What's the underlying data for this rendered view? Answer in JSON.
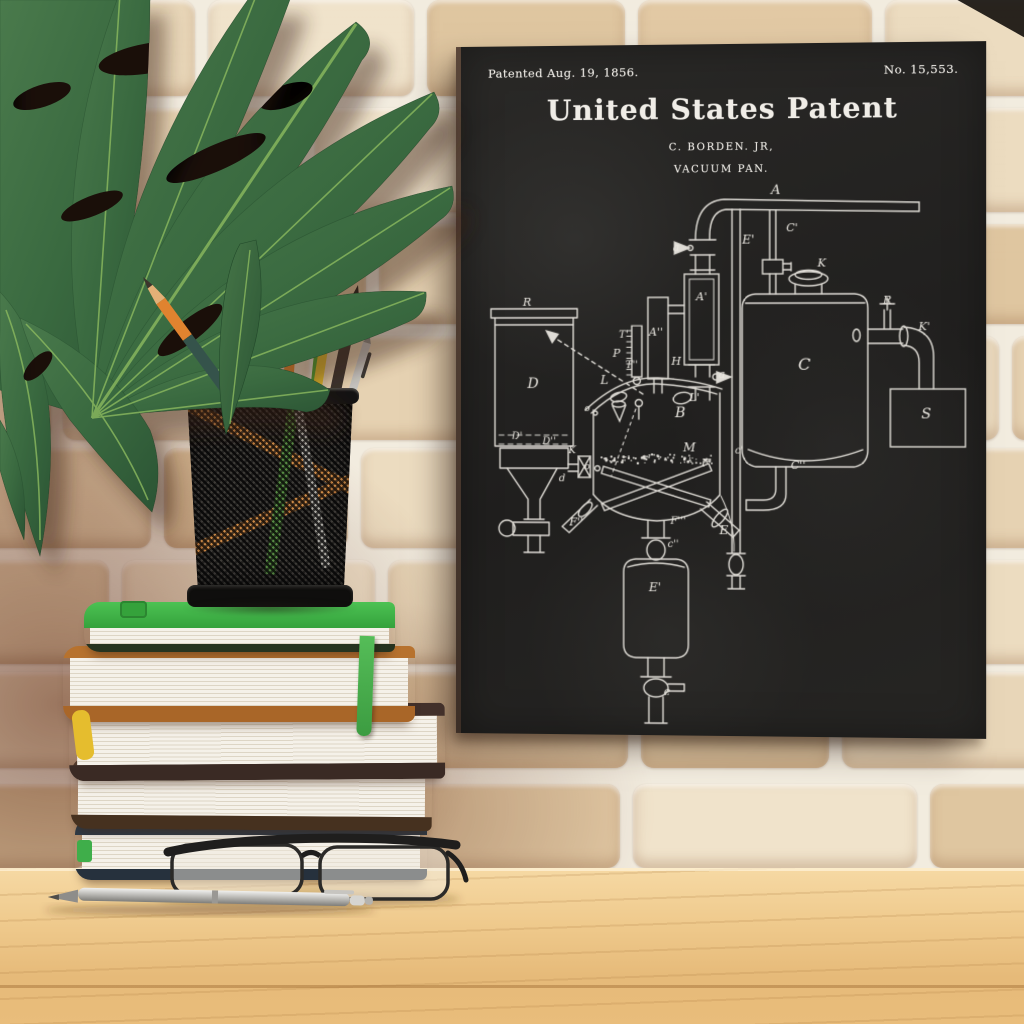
{
  "palette": {
    "mortar": "#f2ecdf",
    "bricks": [
      "#ecdcc0",
      "#e6d2b2",
      "#f0e3cb",
      "#e2c9a4",
      "#eddec2",
      "#e8d6b8",
      "#dfc6a0"
    ],
    "wall_tint_left": "rgba(112,62,45,0.60)",
    "desk_light": "#f6d9a4",
    "desk_dark": "#e6ba79",
    "canvas_black": "#232120",
    "chalk": "#edeae3",
    "leaf_dark": "#2b5434",
    "leaf_light": "#4a7a4c",
    "leaf_vein": "#8cba5f",
    "book_green": "#3fae46",
    "book_caramel": "#b7722e",
    "book_dark_brown": "#42302a",
    "book_brown": "#523a2b",
    "book_navy": "#2d3a47",
    "pages": "#f4f0e8",
    "ribbon_green": "#46b04a",
    "bookmark_yellow": "#e5bd2e",
    "pencil_orange": "#ea8b2e",
    "pencil_teal": "#35534b",
    "pencil_green": "#4da32f",
    "pencil_yellow": "#e0ba2e",
    "pencil_black": "#3b332d",
    "metal_silver": "#c6c5c1",
    "cup_black": "#151413",
    "glasses_frame": "#1f1e1d"
  },
  "canvas_print": {
    "patented": "Patented Aug. 19, 1856.",
    "patent_number": "No. 15,553.",
    "title": "United States Patent",
    "inventor": "C. BORDEN. JR,",
    "subtitle": "VACUUM PAN.",
    "diagram_labels": [
      {
        "t": "A",
        "x": 312,
        "y": 149,
        "s": 13
      },
      {
        "t": "E'",
        "x": 285,
        "y": 198,
        "s": 12
      },
      {
        "t": "a",
        "x": 214,
        "y": 205,
        "s": 11
      },
      {
        "t": "C'",
        "x": 328,
        "y": 186,
        "s": 11
      },
      {
        "t": "K",
        "x": 357,
        "y": 221,
        "s": 11
      },
      {
        "t": "A'",
        "x": 239,
        "y": 254,
        "s": 11
      },
      {
        "t": "A''",
        "x": 194,
        "y": 289,
        "s": 11
      },
      {
        "t": "T'",
        "x": 162,
        "y": 291,
        "s": 10
      },
      {
        "t": "C",
        "x": 340,
        "y": 323,
        "s": 16
      },
      {
        "t": "R",
        "x": 421,
        "y": 258,
        "s": 11
      },
      {
        "t": "K'",
        "x": 457,
        "y": 284,
        "s": 11
      },
      {
        "t": "S",
        "x": 459,
        "y": 371,
        "s": 14
      },
      {
        "t": "R",
        "x": 66,
        "y": 259,
        "s": 11
      },
      {
        "t": "D",
        "x": 72,
        "y": 341,
        "s": 14
      },
      {
        "t": "D'",
        "x": 56,
        "y": 392,
        "s": 10
      },
      {
        "t": "D''",
        "x": 88,
        "y": 397,
        "s": 10
      },
      {
        "t": "P",
        "x": 155,
        "y": 310,
        "s": 11
      },
      {
        "t": "T''",
        "x": 170,
        "y": 321,
        "s": 10
      },
      {
        "t": "L",
        "x": 143,
        "y": 337,
        "s": 12
      },
      {
        "t": "H",
        "x": 214,
        "y": 318,
        "s": 11
      },
      {
        "t": "a",
        "x": 259,
        "y": 331,
        "s": 11
      },
      {
        "t": "o",
        "x": 126,
        "y": 364,
        "s": 9
      },
      {
        "t": "L'",
        "x": 232,
        "y": 354,
        "s": 11
      },
      {
        "t": "B",
        "x": 218,
        "y": 370,
        "s": 14
      },
      {
        "t": "o",
        "x": 126,
        "y": 422,
        "s": 9
      },
      {
        "t": "K",
        "x": 111,
        "y": 406,
        "s": 10
      },
      {
        "t": "d",
        "x": 101,
        "y": 434,
        "s": 10
      },
      {
        "t": "M",
        "x": 227,
        "y": 404,
        "s": 12
      },
      {
        "t": "F'",
        "x": 244,
        "y": 419,
        "s": 11
      },
      {
        "t": "F''",
        "x": 115,
        "y": 478,
        "s": 11
      },
      {
        "t": "F'''",
        "x": 216,
        "y": 476,
        "s": 10
      },
      {
        "t": "c''",
        "x": 211,
        "y": 499,
        "s": 10
      },
      {
        "t": "E",
        "x": 261,
        "y": 486,
        "s": 12
      },
      {
        "t": "c'",
        "x": 276,
        "y": 406,
        "s": 10
      },
      {
        "t": "C''",
        "x": 334,
        "y": 421,
        "s": 11
      },
      {
        "t": "E'",
        "x": 193,
        "y": 543,
        "s": 12
      },
      {
        "t": "e",
        "x": 205,
        "y": 646,
        "s": 11
      }
    ]
  }
}
